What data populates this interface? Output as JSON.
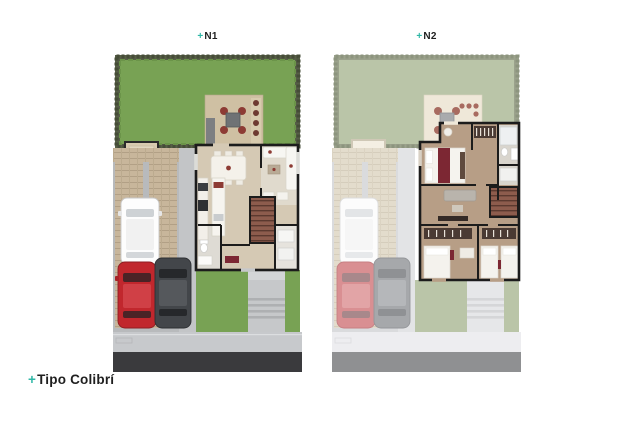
{
  "plans": [
    {
      "id": "n1",
      "plus": "+",
      "name": "N1"
    },
    {
      "id": "n2",
      "plus": "+",
      "name": "N2"
    }
  ],
  "footer": {
    "plus": "+",
    "title": "Tipo Colibrí"
  },
  "palette": {
    "background": "#ffffff",
    "accent": "#2fb7a6",
    "text": "#1f1f1f",
    "grass_n1": "#78a254",
    "hedge_n1": "#565e47",
    "grass_n2": "#bac5a8",
    "hedge_n2": "#9ba28c",
    "road_n1": "#3a3a3d",
    "road_n2": "#8f9092",
    "sidewalk_n1": "#c7c9cc",
    "sidewalk_n2": "#ededf0",
    "wall": "#1c1c1c",
    "terrace_deck": "#cfc0a3",
    "tile_floor": "#d5c9b4",
    "wood_floor": "#b79e86",
    "stairs_wood": "#8d5c4d",
    "maroon_furniture": "#7c2733",
    "red_car": "#c1272d",
    "gray_car": "#43464a",
    "white_car": "#fdfdfd"
  }
}
